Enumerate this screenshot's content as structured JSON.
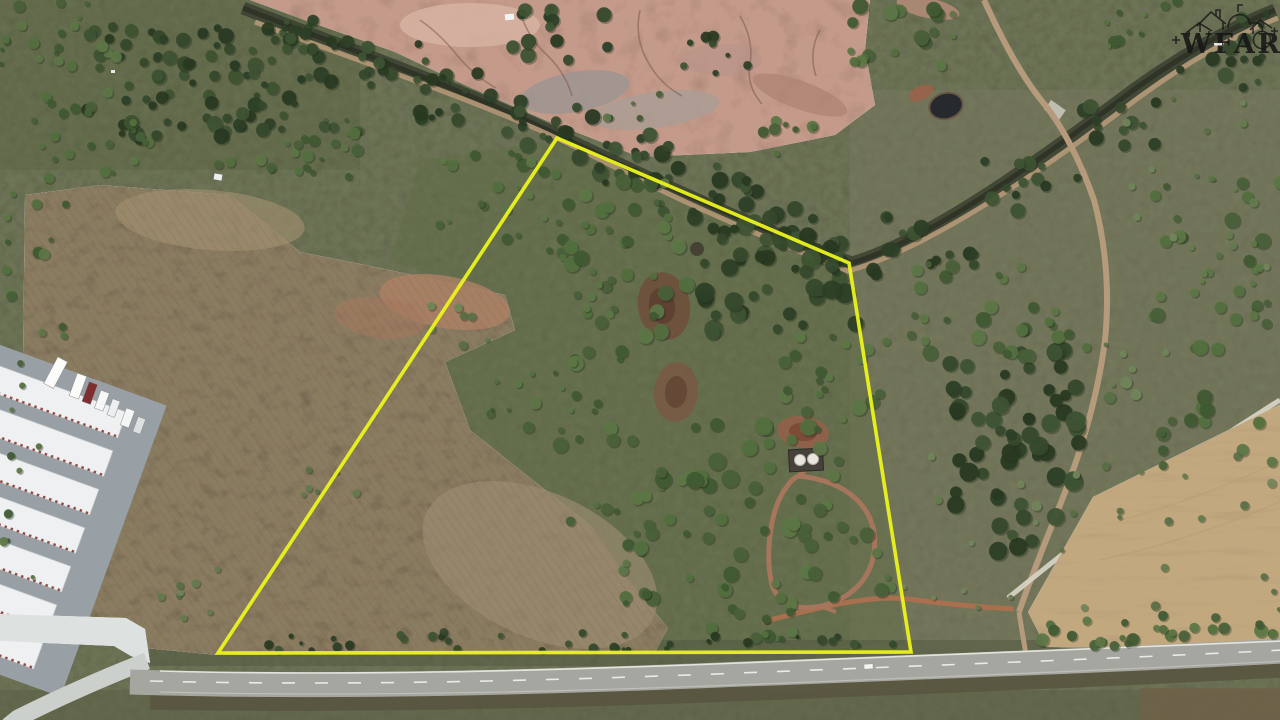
{
  "watermark": {
    "text": "WFAR",
    "style": "black line-art houses logo, top right corner"
  },
  "photo": {
    "kind": "aerial drone photograph",
    "subject": "rural land parcel for sale outlined with a yellow boundary overlay",
    "boundary": {
      "points": "557,138 849,263 911,652 218,653",
      "color": "#ebf31c"
    },
    "visible_features": [
      "yellow property-boundary polygon",
      "pink eroded clay badlands at top center",
      "tree-lined creek running diagonally with dirt service road",
      "large plowed brown field on left",
      "self-storage facility with white-roofed buildings and parked trucks, bottom left",
      "two-lane highway along the bottom edge",
      "small farm pond with red clay ring, upper right",
      "white storage tanks with D-shaped dirt driveway loop inside parcel",
      "tan harvested wheat field, lower right",
      "dirt trails crossing the right side"
    ],
    "palette": {
      "grass": "#6e7456",
      "field": "#8a7b60",
      "badlands": "#c49a8a",
      "creek": "#3a4030",
      "trail": "#b59b7c",
      "red_dirt": "#a8704f",
      "highway": "#a6a6a0",
      "wheat": "#c2a87f",
      "storage_roof": "#eef0f1"
    }
  }
}
